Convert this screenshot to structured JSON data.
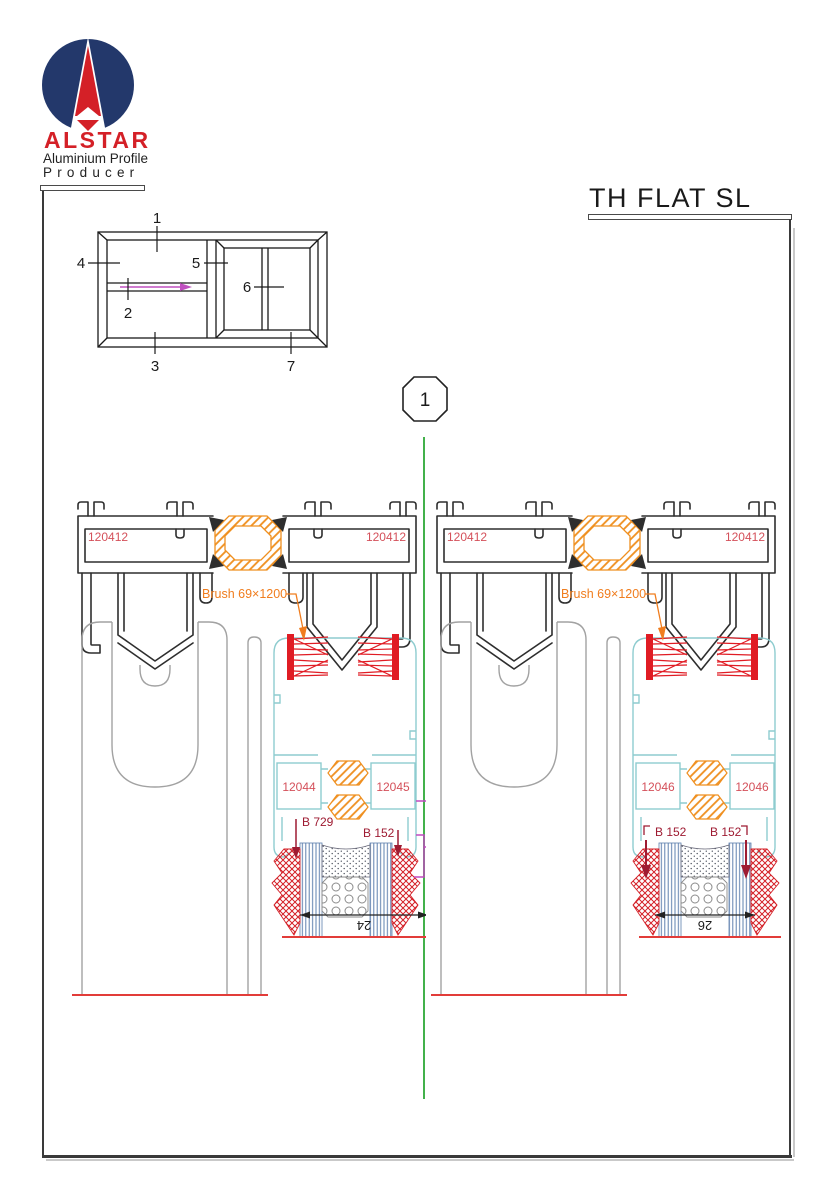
{
  "page": {
    "title": "TH FLAT SL",
    "section_marker": "1"
  },
  "logo": {
    "name": "ALSTAR",
    "line1": "Aluminium Profile",
    "line2": "Producer"
  },
  "schematic": {
    "labels": [
      "1",
      "2",
      "3",
      "4",
      "5",
      "6",
      "7"
    ]
  },
  "details": [
    {
      "id": "left-section",
      "track_label_left": "120412",
      "track_label_right": "120412",
      "brush_label": "Brush 69×1200",
      "chamber_label_left": "12044",
      "chamber_label_right": "12045",
      "gasket_label_left": "B 729",
      "gasket_label_right": "B 152",
      "dimension": "24"
    },
    {
      "id": "right-section",
      "track_label_left": "120412",
      "track_label_right": "120412",
      "brush_label": "Brush 69×1200",
      "chamber_label_left": "12046",
      "chamber_label_right": "12046",
      "gasket_label_left": "B 152",
      "gasket_label_right": "B 152",
      "dimension": "26"
    }
  ],
  "colors": {
    "logo_blue": "#23386b",
    "logo_red": "#d42027",
    "profile_label": "#d4505a",
    "gasket_label": "#9e1b32",
    "brush_label": "#f07d1e",
    "thermal_break": "#ef8f1f",
    "brush_seal": "#e01c24",
    "sash_cyan": "#8ecccf",
    "panel_gray": "#a2a2a2",
    "separator_green": "#43b14b",
    "interlock_magenta": "#c04ac0",
    "baseline_red": "#e23c39"
  }
}
